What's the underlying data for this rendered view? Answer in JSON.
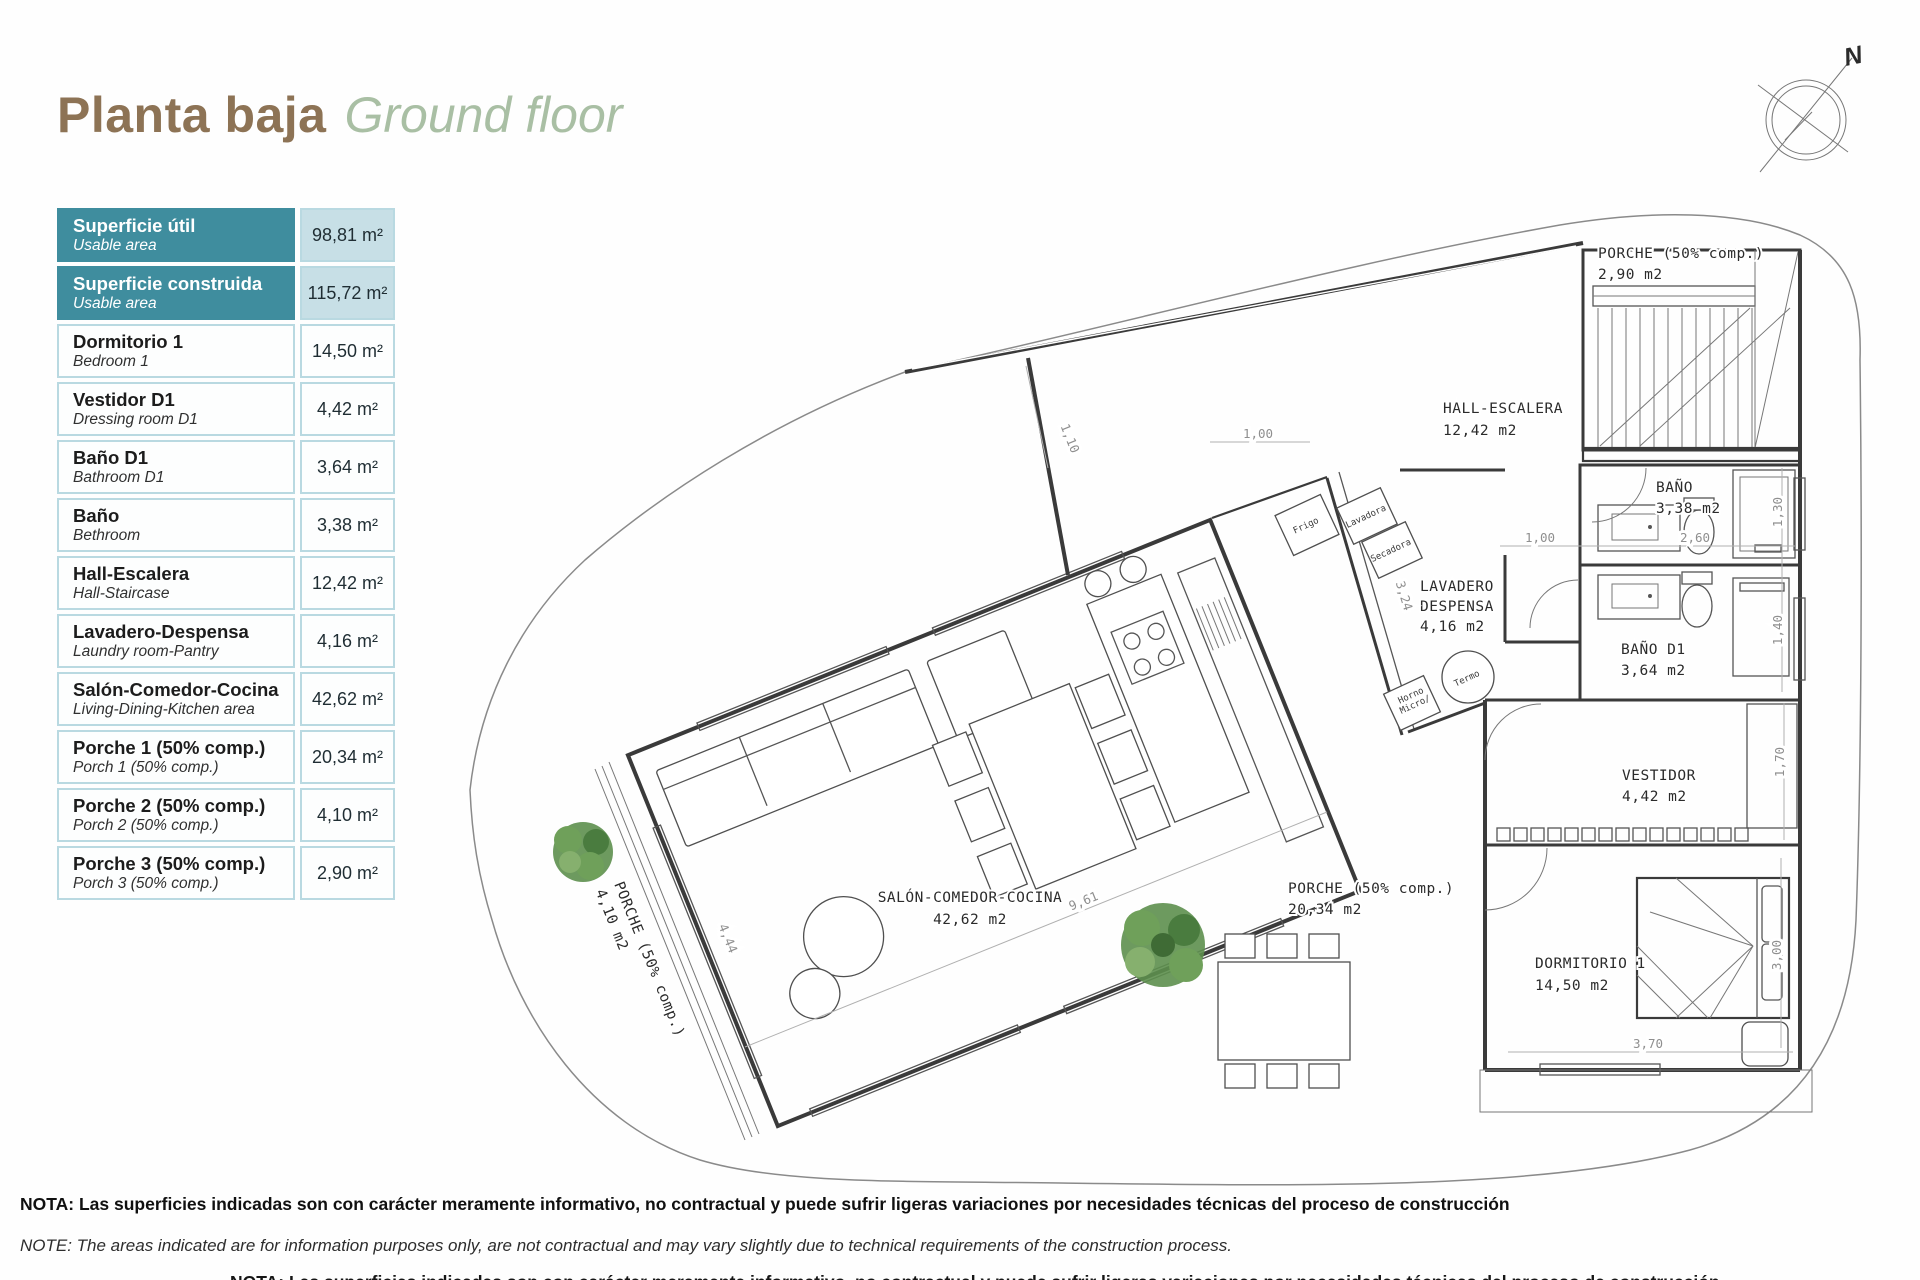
{
  "title": {
    "es": "Planta baja",
    "en": "Ground floor"
  },
  "compass": {
    "label": "N"
  },
  "table": {
    "rows": [
      {
        "es": "Superficie útil",
        "en": "Usable area",
        "value": "98,81 m²",
        "highlight": true
      },
      {
        "es": "Superficie construida",
        "en": "Usable area",
        "value": "115,72 m²",
        "highlight": true
      },
      {
        "es": "Dormitorio 1",
        "en": "Bedroom 1",
        "value": "14,50 m²",
        "highlight": false
      },
      {
        "es": "Vestidor D1",
        "en": "Dressing room D1",
        "value": "4,42 m²",
        "highlight": false
      },
      {
        "es": "Baño D1",
        "en": "Bathroom D1",
        "value": "3,64 m²",
        "highlight": false
      },
      {
        "es": "Baño",
        "en": "Bethroom",
        "value": "3,38 m²",
        "highlight": false
      },
      {
        "es": "Hall-Escalera",
        "en": "Hall-Staircase",
        "value": "12,42 m²",
        "highlight": false
      },
      {
        "es": "Lavadero-Despensa",
        "en": "Laundry room-Pantry",
        "value": "4,16 m²",
        "highlight": false
      },
      {
        "es": "Salón-Comedor-Cocina",
        "en": "Living-Dining-Kitchen area",
        "value": "42,62 m²",
        "highlight": false
      },
      {
        "es": "Porche 1 (50% comp.)",
        "en": "Porch 1 (50% comp.)",
        "value": "20,34 m²",
        "highlight": false
      },
      {
        "es": "Porche 2 (50% comp.)",
        "en": "Porch 2 (50% comp.)",
        "value": "4,10 m²",
        "highlight": false
      },
      {
        "es": "Porche 3 (50% comp.)",
        "en": "Porch 3 (50% comp.)",
        "value": "2,90 m²",
        "highlight": false
      }
    ]
  },
  "plan": {
    "room_labels": [
      {
        "name": "label-porche-3",
        "lines": [
          "PORCHE (50% comp.)",
          "2,90 m2"
        ],
        "x": 1598,
        "y": 258,
        "dy": 21
      },
      {
        "name": "label-hall-escalera",
        "lines": [
          "HALL-ESCALERA",
          "12,42 m2"
        ],
        "x": 1443,
        "y": 413,
        "dy": 22
      },
      {
        "name": "label-bano",
        "lines": [
          "BAÑO",
          "3,38 m2"
        ],
        "x": 1656,
        "y": 492,
        "dy": 21
      },
      {
        "name": "label-lavadero-despensa",
        "lines": [
          "LAVADERO",
          "DESPENSA",
          "4,16 m2"
        ],
        "x": 1420,
        "y": 591,
        "dy": 20
      },
      {
        "name": "label-bano-d1",
        "lines": [
          "BAÑO D1",
          "3,64 m2"
        ],
        "x": 1621,
        "y": 654,
        "dy": 21
      },
      {
        "name": "label-vestidor",
        "lines": [
          "VESTIDOR",
          "4,42 m2"
        ],
        "x": 1622,
        "y": 780,
        "dy": 21
      },
      {
        "name": "label-salon-comedor-cocina",
        "lines": [
          "SALÓN-COMEDOR-COCINA",
          "42,62 m2"
        ],
        "x": 970,
        "y": 902,
        "dy": 22,
        "anchor": "middle"
      },
      {
        "name": "label-porche-1",
        "lines": [
          "PORCHE (50% comp.)",
          "20,34 m2"
        ],
        "x": 1288,
        "y": 893,
        "dy": 21
      },
      {
        "name": "label-dormitorio-1",
        "lines": [
          "DORMITORIO 1",
          "14,50 m2"
        ],
        "x": 1535,
        "y": 968,
        "dy": 22
      },
      {
        "name": "label-porche-2",
        "lines": [
          "PORCHE (50% comp.)",
          "4,10 m2"
        ],
        "x": 614,
        "y": 884,
        "dy": 20,
        "rotate": 68
      }
    ],
    "appliance_labels": [
      {
        "name": "label-frigo",
        "lines": [
          "Frigo"
        ],
        "x": 1307,
        "y": 528,
        "rotate": -25,
        "anchor": "middle"
      },
      {
        "name": "label-lavadora",
        "lines": [
          "Lavadora"
        ],
        "x": 1367,
        "y": 519,
        "rotate": -25,
        "anchor": "middle"
      },
      {
        "name": "label-secadora",
        "lines": [
          "Secadora"
        ],
        "x": 1392,
        "y": 553,
        "rotate": -25,
        "anchor": "middle"
      },
      {
        "name": "label-horno-micro",
        "lines": [
          "Horno",
          "Micro/"
        ],
        "x": 1412,
        "y": 698,
        "dy": 10,
        "rotate": -25,
        "anchor": "middle"
      },
      {
        "name": "label-termo",
        "lines": [
          "Termo"
        ],
        "x": 1468,
        "y": 681,
        "rotate": -25,
        "anchor": "middle"
      }
    ],
    "dimension_labels": [
      {
        "text": "1,10",
        "x": 1066,
        "y": 440,
        "rotate": 68
      },
      {
        "text": "1,00",
        "x": 1258,
        "y": 438
      },
      {
        "text": "9,61",
        "x": 1085,
        "y": 905,
        "rotate": -22
      },
      {
        "text": "4,44",
        "x": 724,
        "y": 940,
        "rotate": 68
      },
      {
        "text": "3,24",
        "x": 1400,
        "y": 597,
        "rotate": 73
      },
      {
        "text": "1,00",
        "x": 1540,
        "y": 542
      },
      {
        "text": "2,60",
        "x": 1695,
        "y": 542
      },
      {
        "text": "1,30",
        "x": 1782,
        "y": 512,
        "rotate": -90
      },
      {
        "text": "1,40",
        "x": 1782,
        "y": 630,
        "rotate": -90
      },
      {
        "text": "1,70",
        "x": 1784,
        "y": 762,
        "rotate": -90
      },
      {
        "text": "3,00",
        "x": 1781,
        "y": 955,
        "rotate": -90
      },
      {
        "text": "3,70",
        "x": 1648,
        "y": 1048
      }
    ]
  },
  "notes": {
    "es": "NOTA: Las superficies indicadas son con carácter meramente informativo, no contractual y puede sufrir ligeras variaciones por necesidades técnicas del proceso de construcción",
    "en": "NOTE: The areas indicated are for information purposes only, are not contractual and may vary slightly due to technical requirements of the construction process."
  },
  "colors": {
    "teal": "#3F8D9E",
    "teal_light": "#C7DFE6",
    "border": "#B9D9E1",
    "title_brown": "#8D7355",
    "title_green": "#A9BFA4"
  }
}
